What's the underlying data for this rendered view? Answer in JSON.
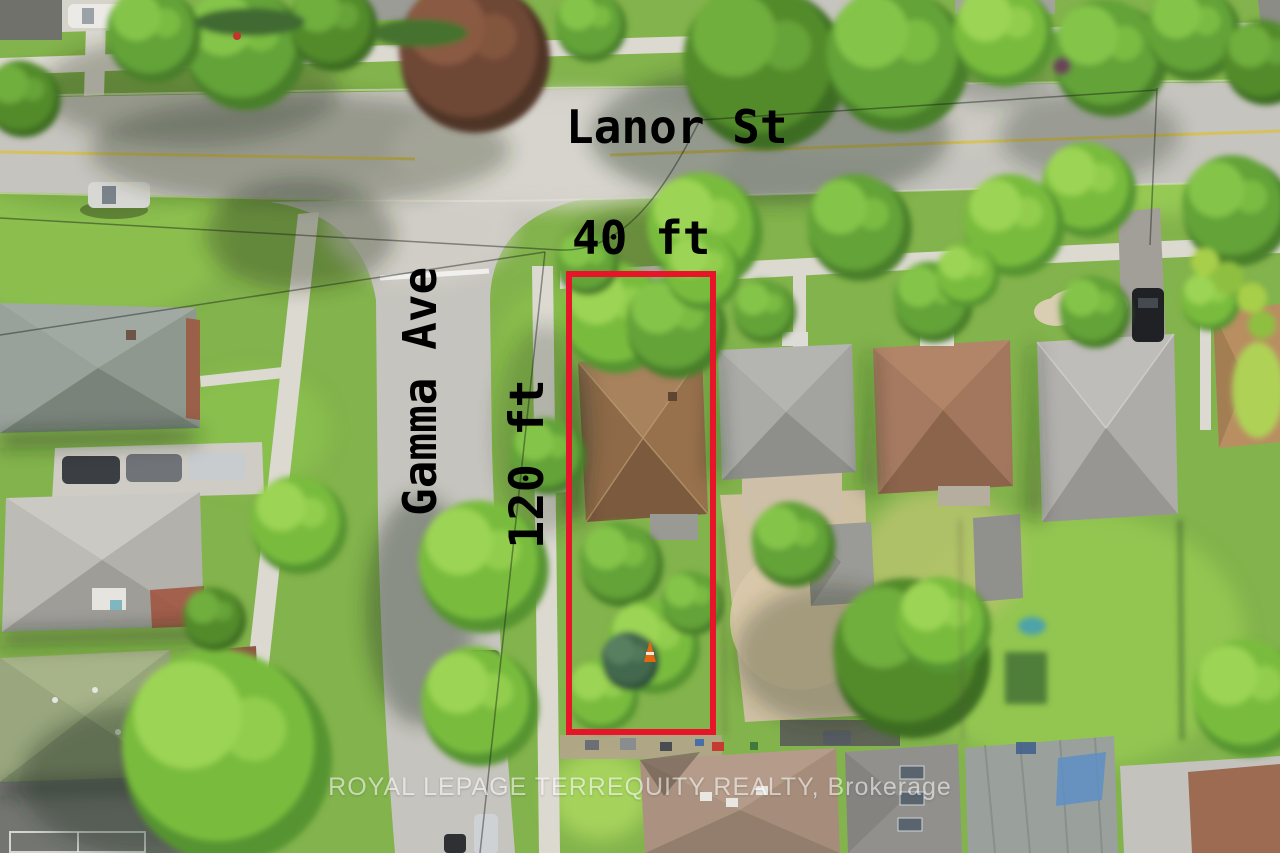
{
  "photo": {
    "type": "aerial-drone-photo",
    "subject": "Residential corner lot outlined in red at Lanor St and Gamma Ave"
  },
  "labels": {
    "street_horizontal": "Lanor St",
    "street_vertical": "Gamma Ave",
    "lot_width": "40 ft",
    "lot_depth": "120 ft"
  },
  "watermark": {
    "text": "ROYAL LEPAGE TERREQUITY REALTY, Brokerage"
  },
  "colors": {
    "lot_outline": "#e8142a",
    "annotation_text": "#000000",
    "watermark_text": "#ffffff"
  }
}
